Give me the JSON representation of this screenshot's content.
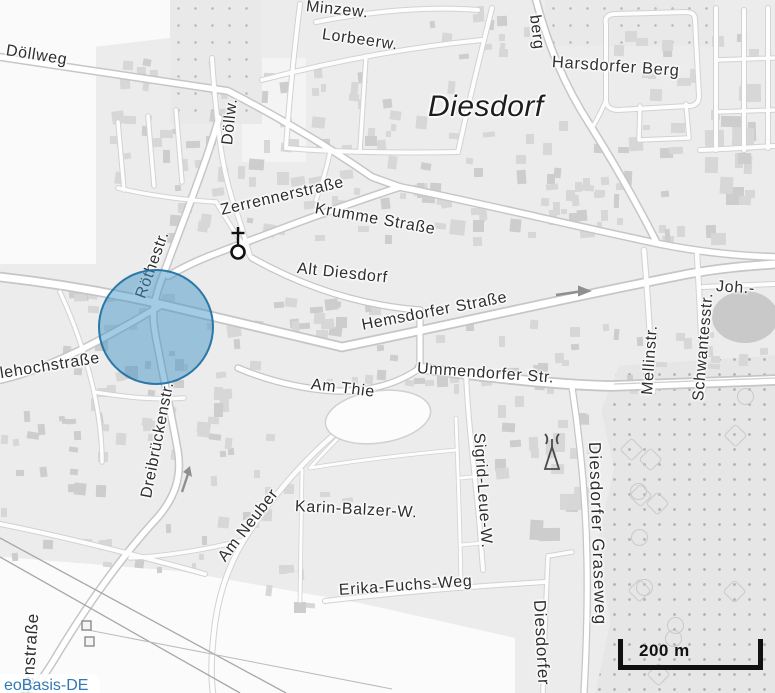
{
  "map": {
    "scale_text": "200 m",
    "attribution_text": "eoBasis-DE",
    "colors": {
      "marker_fill": "#3E92C7",
      "marker_stroke": "#176B9E",
      "attribution_blue": "#3179B5",
      "land": "#ECECEC",
      "building": "#D6D6D6",
      "road_fill": "#FFFFFF",
      "road_casing": "#C6C6C6"
    },
    "icons": {
      "church": "church-icon",
      "telecom_mast": "telecom-mast-icon",
      "oneway_right": "oneway-arrow-icon",
      "oneway_up": "oneway-arrow-icon"
    }
  },
  "places": {
    "city": "Diesdorf",
    "district": "Harsdorfer Berg"
  },
  "streets": {
    "dollweg": "Döllweg",
    "dollw_abbr": "Döllw.",
    "minzew": "Minzew.",
    "lorbeerw": "Lorbeerw.",
    "berg": "berg",
    "zerrennerstrasse": "Zerrennerstraße",
    "krumme_strasse": "Krumme Straße",
    "alt_diesdorf": "Alt Diesdorf",
    "roethestr": "Röthestr.",
    "hemsdorfer_strasse": "Hemsdorfer Straße",
    "ummendorfer_str": "Ummendorfer Str.",
    "am_thie": "Am Thie",
    "llehochstrasse": "llehochstraße",
    "mellinstr": "Mellinstr.",
    "schwantesstr": "Schwantesstr.",
    "joh": "Joh.-",
    "dreibrueckenstr": "Dreibrückenstr.",
    "ckenstrasse": "ckenstraße",
    "am_neuber": "Am Neuber",
    "karin_balzer": "Karin-Balzer-W.",
    "sigrid_leue": "Sigrid-Leue-W.",
    "erika_fuchs": "Erika-Fuchs-Weg",
    "diesdorfer_graseweg": "Diesdorfer Graseweg",
    "diesdorfer_cut": "Diesdorfer"
  }
}
